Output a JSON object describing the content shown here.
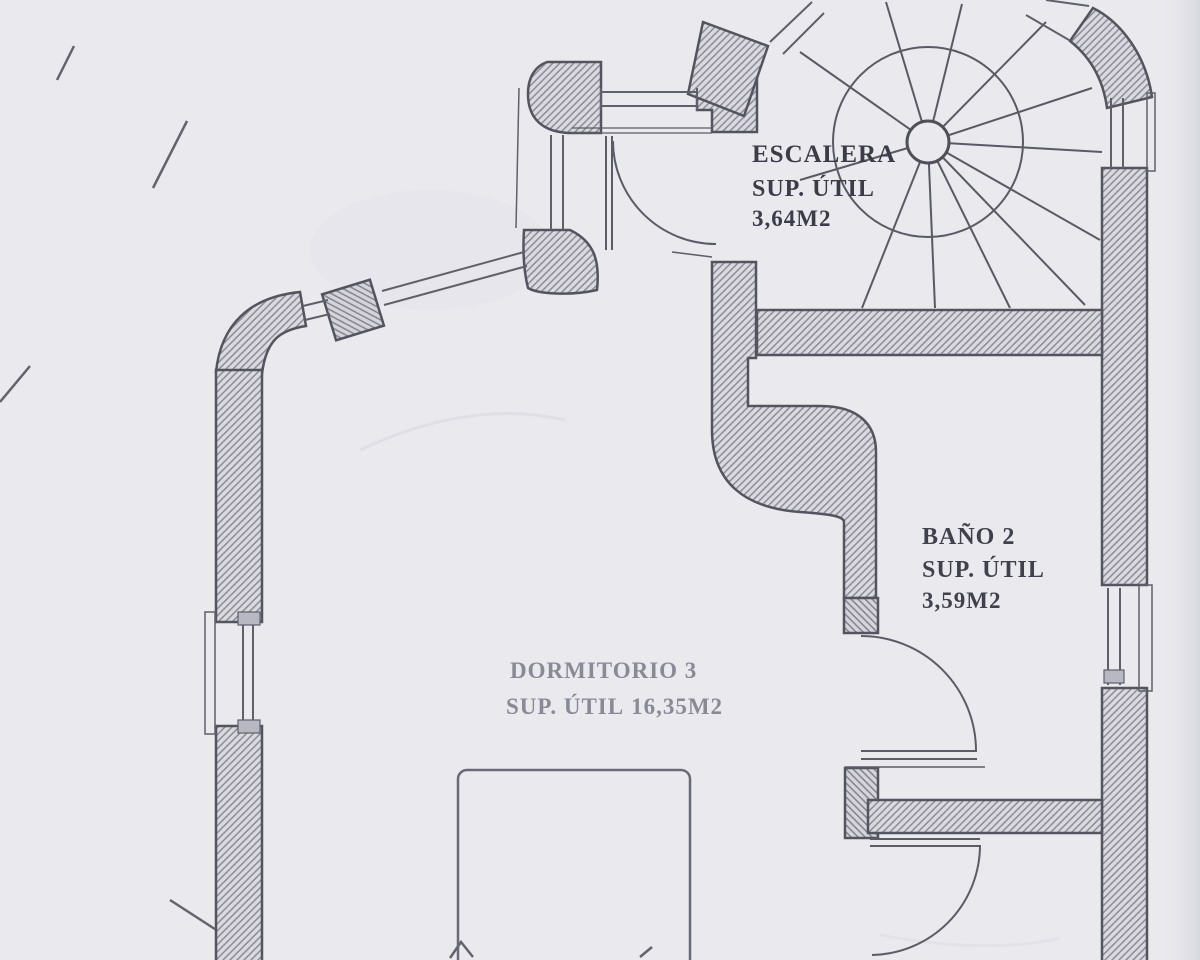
{
  "plan": {
    "title": "floor-plan-scan",
    "rooms": [
      {
        "name": "ESCALERA",
        "area_label": "SUP. ÚTIL",
        "area": "3,64M2"
      },
      {
        "name": "BAÑO 2",
        "area_label": "SUP. ÚTIL",
        "area": "3,59M2"
      },
      {
        "name": "DORMITORIO 3",
        "area_label": "SUP. ÚTIL",
        "area": "16,35M2"
      }
    ],
    "features": {
      "stair": "spiral-staircase",
      "doors": 3,
      "windows": 7,
      "furniture": "bed"
    },
    "colors": {
      "paper": "#e9e9ee",
      "ink": "#54545e",
      "wall_fill": "#d9d9df",
      "hatch": "#8b8b96",
      "dark_text": "#3c3c48",
      "faded_text": "#8a8a96"
    }
  }
}
